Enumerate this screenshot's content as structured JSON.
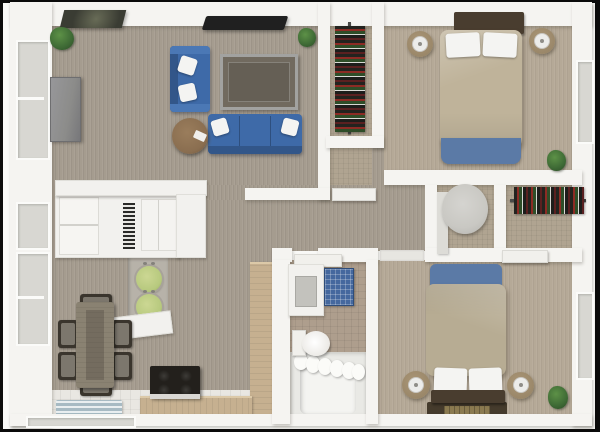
{
  "meta": {
    "description": "3D rendered top-down floor plan of a two-bedroom, two-bath apartment",
    "render_style": "3d-dollhouse-floorplan",
    "visible_text": ""
  },
  "palette": {
    "frame": "#0b0b0b",
    "backdrop": "#f9f9f7",
    "wall": "#f5f4f1",
    "glass": "#d8d7d2",
    "carpet": "#a59c8f",
    "carpet-warm": "#b5a997",
    "closet-floor": "#b0a491",
    "bath-floor": "#ae9e8d",
    "kitchen-tile": "#e9e7e2",
    "wood": "#c6b090",
    "table-wood": "#8a8272",
    "chair-dark": "#3a352d",
    "chair-seat": "#7c776d",
    "sofa-blue": "#3e6aa8",
    "throw-blue": "#5b7aa6",
    "duvet": "#bfb39a",
    "headboard": "#493d2f",
    "nightstand": "#9a8769",
    "lamp-white": "#ececea",
    "ottoman": "#8a6e50",
    "appliance-green": "#b7c97e",
    "rug-blue": "#a7bac3",
    "stove-black": "#23201c",
    "plant-green": "#3e6a35",
    "plant-dark": "#2c4a26",
    "tv-black": "#202020",
    "tv-gray": "#8c8c8a",
    "fixture-gray": "#c9c8c3",
    "pillow": "#f4f4f2",
    "bed-rug": "#453b2c",
    "bed-rug-gold": "#8b7a50",
    "art-dark": "#3a3c33",
    "crate-blue": "#45689e",
    "rod": "#4a4a48"
  },
  "rooms": [
    {
      "name": "living-room",
      "items": [
        "wall-art",
        "flat-screen-tv",
        "tv-panel",
        "loveseat",
        "sofa",
        "coffee-table",
        "round-ottoman",
        "corner-plants",
        "windows"
      ]
    },
    {
      "name": "dining-area",
      "items": [
        "dining-table",
        "six-chairs",
        "kitchen-cabinet-unit",
        "washer",
        "dryer",
        "counter"
      ]
    },
    {
      "name": "kitchen",
      "items": [
        "l-shaped-wood-counter",
        "stove",
        "striped-blue-rug",
        "tile-floor"
      ]
    },
    {
      "name": "bedroom-1",
      "items": [
        "double-bed",
        "blue-throw",
        "two-nightstand-lamps",
        "hanging-clothes-closet",
        "plant",
        "window"
      ]
    },
    {
      "name": "bedroom-2",
      "items": [
        "double-bed",
        "blue-throw",
        "two-nightstand-lamps",
        "dark-floor-rug",
        "plant",
        "window"
      ]
    },
    {
      "name": "bathroom",
      "items": [
        "vanity-sink",
        "blue-crate",
        "toilet",
        "bathtub",
        "shower-curtain"
      ]
    },
    {
      "name": "wc-room",
      "items": [
        "round-basin",
        "side-vanity"
      ]
    },
    {
      "name": "walk-in-closet",
      "items": [
        "clothes-rail",
        "hanging-clothes"
      ]
    }
  ]
}
